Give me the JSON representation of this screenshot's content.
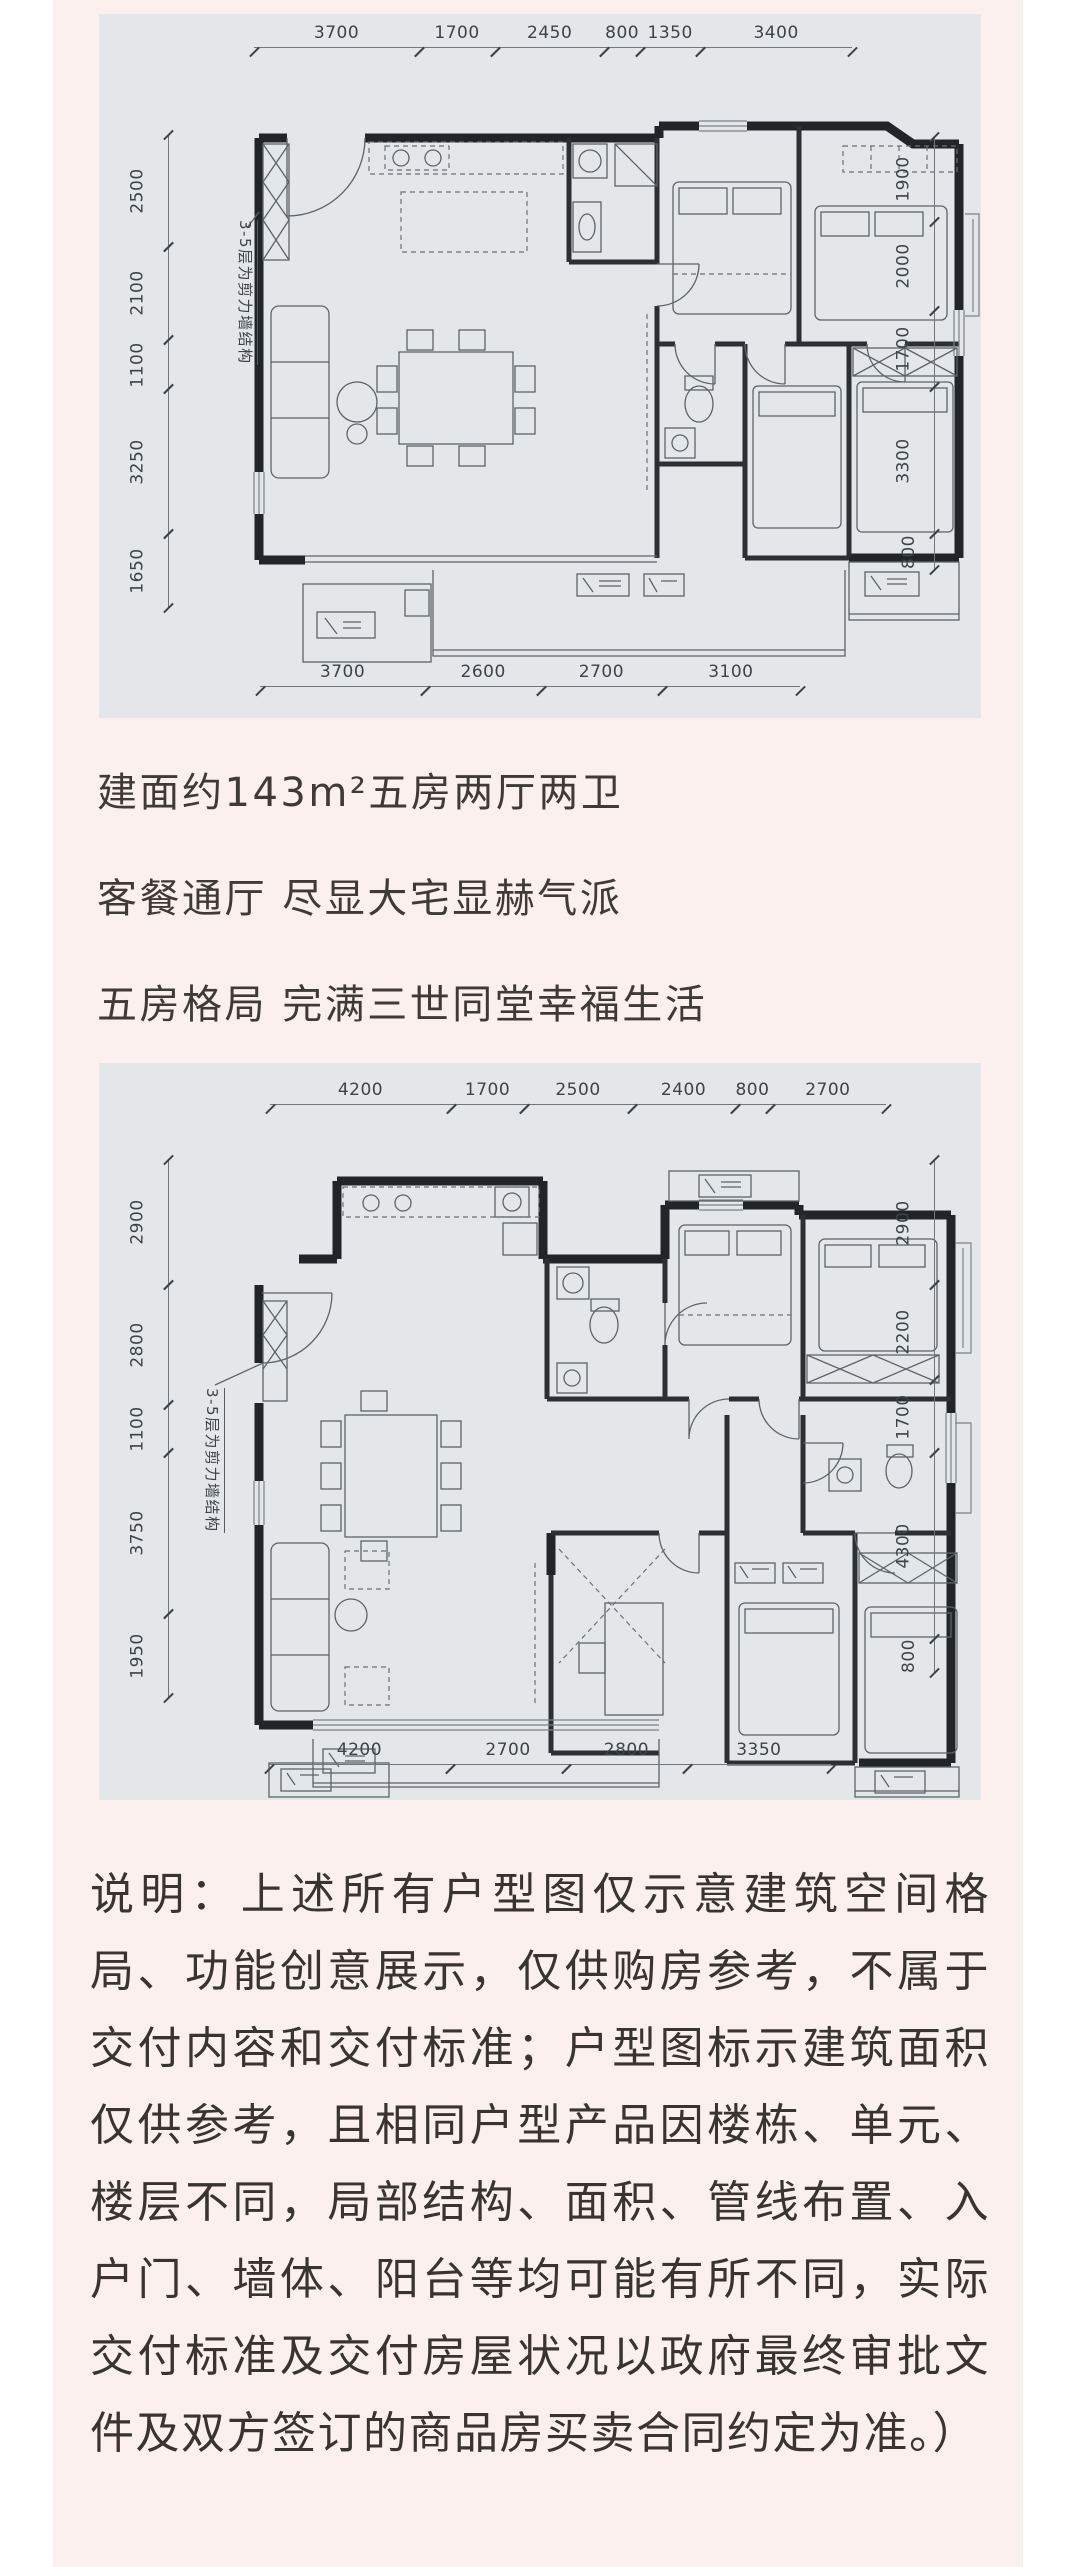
{
  "plans": {
    "plan1": {
      "dims_top": [
        "3700",
        "1700",
        "2450",
        "800",
        "1350",
        "3400"
      ],
      "dims_left": [
        "2500",
        "2100",
        "1100",
        "3250",
        "1650"
      ],
      "dims_right": [
        "1900",
        "2000",
        "1700",
        "3300",
        "800"
      ],
      "dims_bottom": [
        "3700",
        "2600",
        "2700",
        "3100"
      ],
      "note": "3-5层为剪力墙结构"
    },
    "plan2": {
      "dims_top": [
        "4200",
        "1700",
        "2500",
        "2400",
        "800",
        "2700"
      ],
      "dims_left": [
        "2900",
        "2800",
        "1100",
        "3750",
        "1950"
      ],
      "dims_right": [
        "2900",
        "2200",
        "1700",
        "4300",
        "800"
      ],
      "dims_bottom": [
        "4200",
        "2700",
        "2800",
        "3350"
      ],
      "note": "3-5层为剪力墙结构"
    }
  },
  "headline": {
    "line1": "建面约143m²五房两厅两卫",
    "line2": "客餐通厅 尽显大宅显赫气派",
    "line3": "五房格局 完满三世同堂幸福生活"
  },
  "disclaimer": "说明：上述所有户型图仅示意建筑空间格局、功能创意展示，仅供购房参考，不属于交付内容和交付标准；户型图标示建筑面积仅供参考，且相同户型产品因楼栋、单元、楼层不同，局部结构、面积、管线布置、入户门、墙体、阳台等均可能有所不同，实际交付标准及交付房屋状况以政府最终审批文件及双方签订的商品房买卖合同约定为准。）",
  "colors": {
    "card_bg": "#fcf0ef",
    "plan_bg": "#e4e7e9",
    "text": "#393430"
  }
}
